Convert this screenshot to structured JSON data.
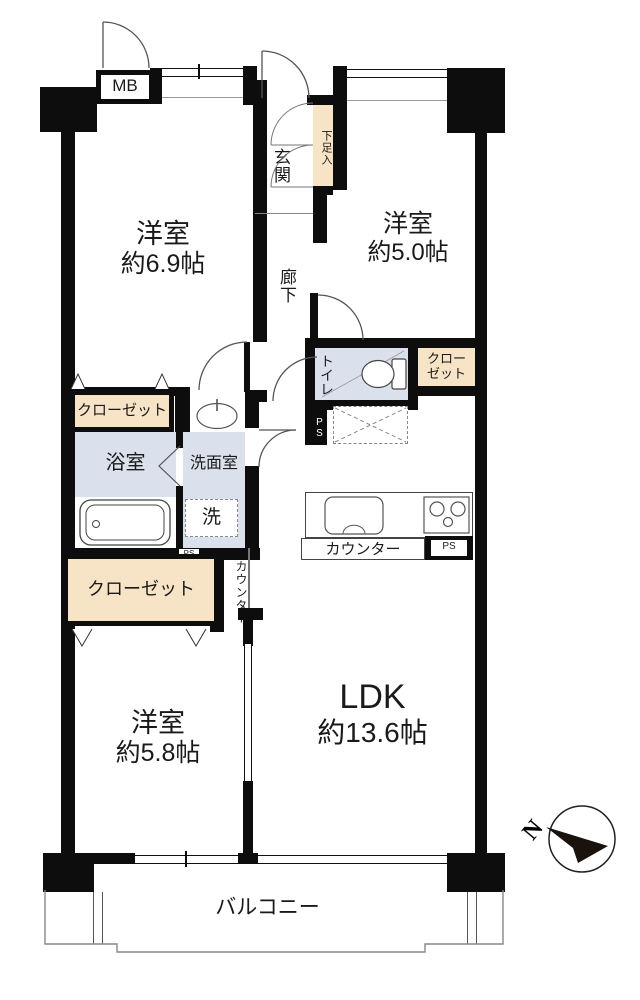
{
  "rooms": {
    "bedroom69": {
      "label": "洋室",
      "area": "約6.9帖"
    },
    "bedroom50": {
      "label": "洋室",
      "area": "約5.0帖"
    },
    "bedroom58": {
      "label": "洋室",
      "area": "約5.8帖"
    },
    "ldk": {
      "label": "LDK",
      "area": "約13.6帖"
    },
    "entrance": {
      "label": "玄関"
    },
    "hallway": {
      "label": "廊下"
    },
    "toilet": {
      "label": "トイレ"
    },
    "bathroom": {
      "label": "浴室"
    },
    "washroom": {
      "label": "洗面室"
    },
    "laundry": {
      "label": "洗"
    },
    "balcony": {
      "label": "バルコニー"
    }
  },
  "fixtures": {
    "meter_box": "MB",
    "shoe_cabinet": "下足入",
    "closet": "クローゼット",
    "closet_line1": "クロー",
    "closet_line2": "ゼット",
    "counter": "カウンター",
    "pipe_space": "PS",
    "north": "N"
  },
  "colors": {
    "wall": "#0d0d0d",
    "closet_fill": "#f7e3c5",
    "wet_area_fill": "#dae1ec",
    "thin_line": "#444444"
  }
}
